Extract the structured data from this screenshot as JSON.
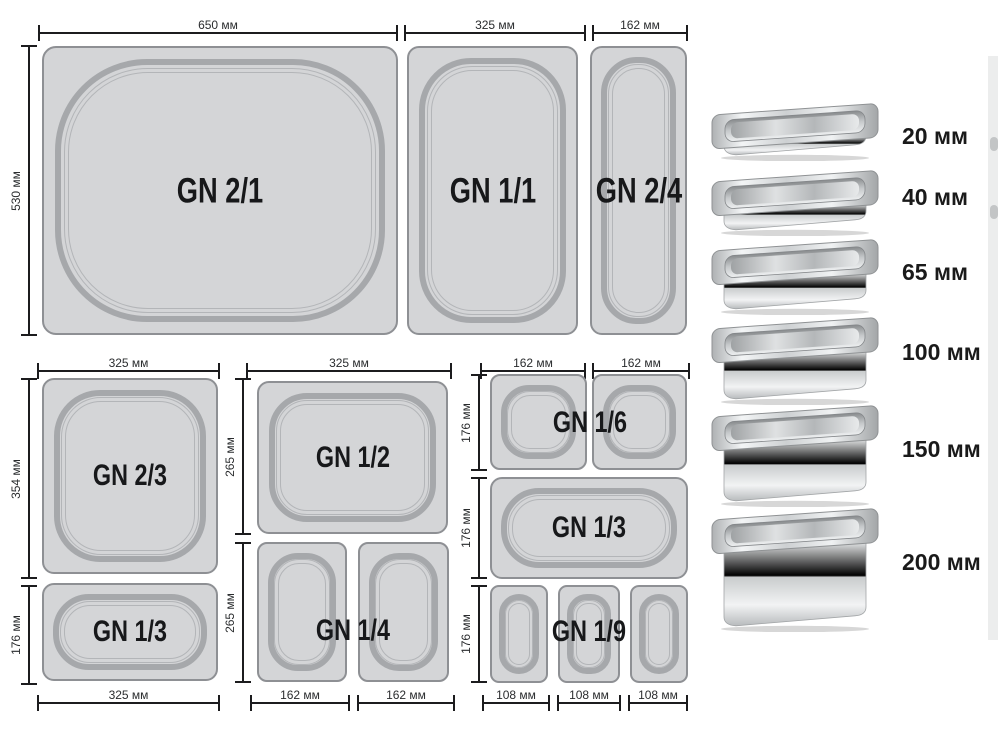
{
  "sections": {
    "top": {
      "widths": [
        "650 мм",
        "325 мм",
        "162 мм"
      ],
      "height": "530 мм",
      "pans": [
        "GN 2/1",
        "GN 1/1",
        "GN 2/4"
      ]
    },
    "bottom_left": {
      "top_width": "325 мм",
      "heights": [
        "354 мм",
        "176 мм"
      ],
      "pans": [
        "GN 2/3",
        "GN 1/3"
      ],
      "bottom_width": "325 мм"
    },
    "bottom_middle": {
      "top_width": "325 мм",
      "heights": [
        "265 мм",
        "265 мм"
      ],
      "pans": [
        "GN 1/2",
        "GN 1/4"
      ],
      "bottom_widths": [
        "162 мм",
        "162 мм"
      ]
    },
    "bottom_right": {
      "top_widths": [
        "162 мм",
        "162 мм"
      ],
      "heights": [
        "176 мм",
        "176 мм",
        "176 мм"
      ],
      "pans": [
        "GN 1/6",
        "GN 1/3",
        "GN 1/9"
      ],
      "bottom_widths": [
        "108 мм",
        "108 мм",
        "108 мм"
      ]
    },
    "depths": [
      "20 мм",
      "40 мм",
      "65 мм",
      "100 мм",
      "150 мм",
      "200 мм"
    ],
    "colors": {
      "pan_fill": "#d4d5d7",
      "pan_border": "#8e9094",
      "rim": "#a6a8ab",
      "dimension_line": "#1c1c1e",
      "label_text": "#17181a"
    }
  }
}
